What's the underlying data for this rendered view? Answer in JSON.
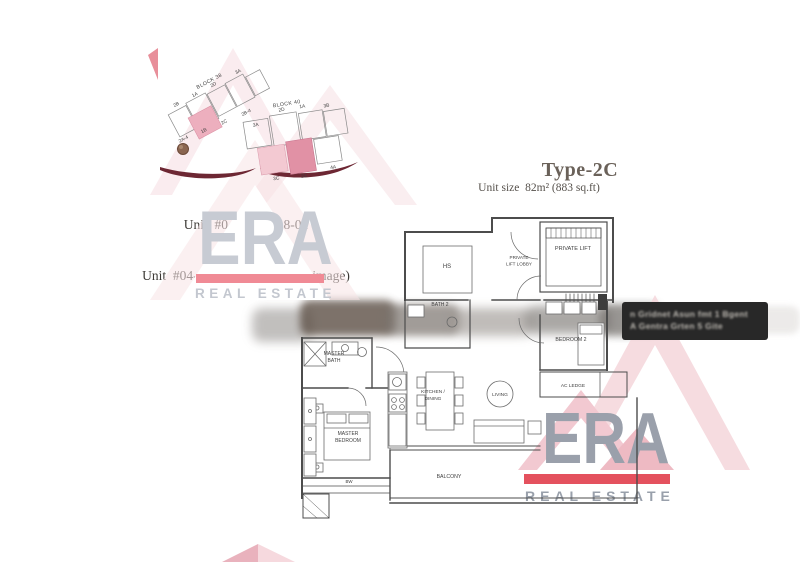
{
  "unit_info": {
    "line1": "Unit  #04-02 to #18-02",
    "line2": "Unit  #04-10 to #18-10 (mirror image)"
  },
  "type_info": {
    "title": "Type-2C",
    "size": "Unit size  82m² (883 sq.ft)"
  },
  "site_plan": {
    "block38": {
      "label": "BLOCK 38",
      "top_units": [
        "2B",
        "1A",
        "2D",
        "3A"
      ],
      "bottom_units": [
        "2A-4",
        "1B",
        "2C",
        "2B-4"
      ],
      "highlighted_unit": "2C"
    },
    "block40": {
      "label": "BLOCK 40",
      "top_units": [
        "3A",
        "2D",
        "1A",
        "3B"
      ],
      "bottom_units": [
        "3C",
        "2C",
        "4A"
      ],
      "highlighted_unit": "2C"
    },
    "highlight_color": "#e191a5"
  },
  "floor_plan": {
    "labels": {
      "hs": "HS",
      "lobby1": "PRIVATE",
      "lobby2": "LIFT LOBBY",
      "private_lift": "PRIVATE LIFT",
      "bath2": "BATH 2",
      "master_bath1": "MASTER",
      "master_bath2": "BATH",
      "bedroom2": "BEDROOM 2",
      "ac_ledge": "AC LEDGE",
      "kitchen1": "KITCHEN /",
      "kitchen2": "DINING",
      "living": "LIVING",
      "master_bedroom1": "MASTER",
      "master_bedroom2": "BEDROOM",
      "bw": "BW",
      "balcony": "BALCONY"
    }
  },
  "tooltip": {
    "line1": "n Gridnet Asun fmt 1 Bgent",
    "line2": "A Gentra Grten 5 Gite"
  },
  "watermark": {
    "brand": "ERA",
    "subtitle": "REAL ESTATE",
    "colors": {
      "letters_light": "#c7cbd3",
      "letters_dark": "#9aa0ab",
      "bar_light": "#f08a95",
      "bar_dark": "#e4515e",
      "roof_pink": "#f5d6db",
      "roof_deep": "#eebac3"
    }
  }
}
